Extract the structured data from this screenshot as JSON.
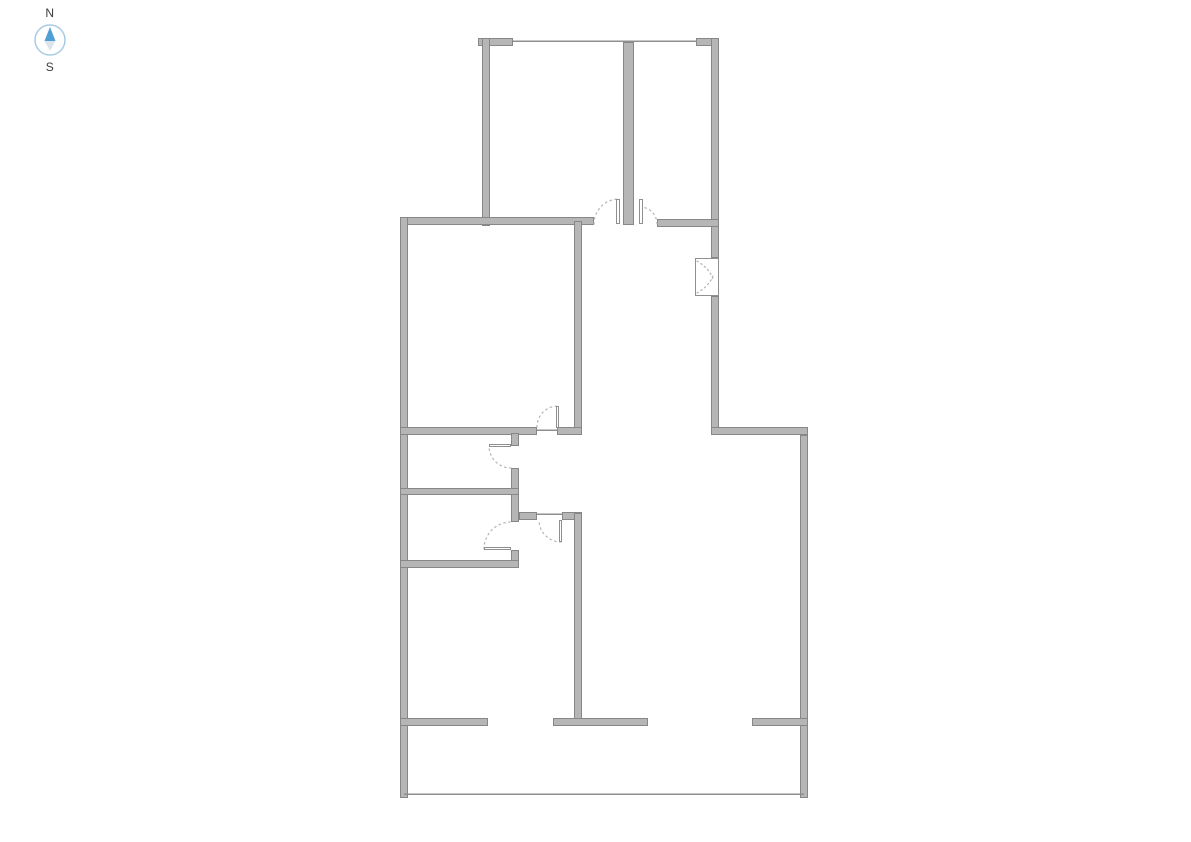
{
  "compass": {
    "north_label": "N",
    "south_label": "S",
    "label_color": "#3c3c3c",
    "ring_color": "#a9cbe1",
    "needle_up_color": "#4e9fd4",
    "needle_down_color": "#dde5ea"
  },
  "floor_plan": {
    "background": "#ffffff",
    "wall_fill": "#b6b6b6",
    "wall_edge": "#878787",
    "line_color": "#8f8f8f",
    "arc_color": "#b3b3b3",
    "walls": [
      {
        "x": 478,
        "y": 38,
        "w": 35,
        "h": 8
      },
      {
        "x": 482,
        "y": 38,
        "w": 8,
        "h": 188
      },
      {
        "x": 696,
        "y": 38,
        "w": 23,
        "h": 8
      },
      {
        "x": 711,
        "y": 38,
        "w": 8,
        "h": 220
      },
      {
        "x": 623,
        "y": 42,
        "w": 11,
        "h": 183
      },
      {
        "x": 400,
        "y": 217,
        "w": 194,
        "h": 8
      },
      {
        "x": 657,
        "y": 219,
        "w": 62,
        "h": 8
      },
      {
        "x": 400,
        "y": 217,
        "w": 8,
        "h": 581
      },
      {
        "x": 574,
        "y": 221,
        "w": 8,
        "h": 213
      },
      {
        "x": 711,
        "y": 296,
        "w": 8,
        "h": 139
      },
      {
        "x": 711,
        "y": 427,
        "w": 97,
        "h": 8
      },
      {
        "x": 800,
        "y": 435,
        "w": 8,
        "h": 363
      },
      {
        "x": 400,
        "y": 427,
        "w": 137,
        "h": 8
      },
      {
        "x": 557,
        "y": 427,
        "w": 25,
        "h": 8
      },
      {
        "x": 511,
        "y": 433,
        "w": 8,
        "h": 13
      },
      {
        "x": 511,
        "y": 468,
        "w": 8,
        "h": 54
      },
      {
        "x": 511,
        "y": 550,
        "w": 8,
        "h": 18
      },
      {
        "x": 400,
        "y": 488,
        "w": 119,
        "h": 7
      },
      {
        "x": 400,
        "y": 560,
        "w": 119,
        "h": 8
      },
      {
        "x": 519,
        "y": 512,
        "w": 18,
        "h": 8
      },
      {
        "x": 562,
        "y": 512,
        "w": 20,
        "h": 8
      },
      {
        "x": 574,
        "y": 513,
        "w": 8,
        "h": 213
      },
      {
        "x": 400,
        "y": 718,
        "w": 88,
        "h": 8
      },
      {
        "x": 553,
        "y": 718,
        "w": 95,
        "h": 8
      },
      {
        "x": 752,
        "y": 718,
        "w": 56,
        "h": 8
      }
    ],
    "thin_lines": [
      {
        "name": "window-wall-line",
        "x1": 513,
        "y1": 41,
        "x2": 697,
        "y2": 41
      },
      {
        "name": "threshold-line",
        "x1": 537,
        "y1": 430,
        "x2": 558,
        "y2": 430
      },
      {
        "name": "threshold-line",
        "x1": 537,
        "y1": 514,
        "x2": 562,
        "y2": 514
      },
      {
        "name": "patio-edge-line",
        "x1": 404,
        "y1": 794,
        "x2": 804,
        "y2": 794
      }
    ],
    "door_panels": [
      {
        "x": 616,
        "y": 199,
        "w": 4,
        "h": 25
      },
      {
        "x": 639,
        "y": 199,
        "w": 4,
        "h": 25
      },
      {
        "x": 556,
        "y": 406,
        "w": 3,
        "h": 22
      },
      {
        "x": 489,
        "y": 444,
        "w": 22,
        "h": 3
      },
      {
        "x": 484,
        "y": 547,
        "w": 27,
        "h": 3
      },
      {
        "x": 559,
        "y": 520,
        "w": 3,
        "h": 22
      }
    ],
    "door_arcs": [
      {
        "cx": 619,
        "cy": 224,
        "r": 25,
        "a1": 180,
        "a2": 270
      },
      {
        "cx": 640,
        "cy": 224,
        "r": 17,
        "a1": 270,
        "a2": 360
      },
      {
        "cx": 558,
        "cy": 427,
        "r": 21,
        "a1": 180,
        "a2": 270
      },
      {
        "cx": 511,
        "cy": 446,
        "r": 22,
        "a1": 90,
        "a2": 180
      },
      {
        "cx": 511,
        "cy": 549,
        "r": 27,
        "a1": 180,
        "a2": 270
      },
      {
        "cx": 561,
        "cy": 520,
        "r": 22,
        "a1": 90,
        "a2": 180
      }
    ],
    "folding_door": {
      "box": {
        "x": 695,
        "y": 258,
        "w": 24,
        "h": 38
      },
      "curves": [
        {
          "p0": [
            697,
            261
          ],
          "c": [
            709,
            268
          ],
          "p1": [
            713,
            279
          ]
        },
        {
          "p0": [
            697,
            293
          ],
          "c": [
            709,
            286
          ],
          "p1": [
            713,
            276
          ]
        }
      ]
    }
  }
}
